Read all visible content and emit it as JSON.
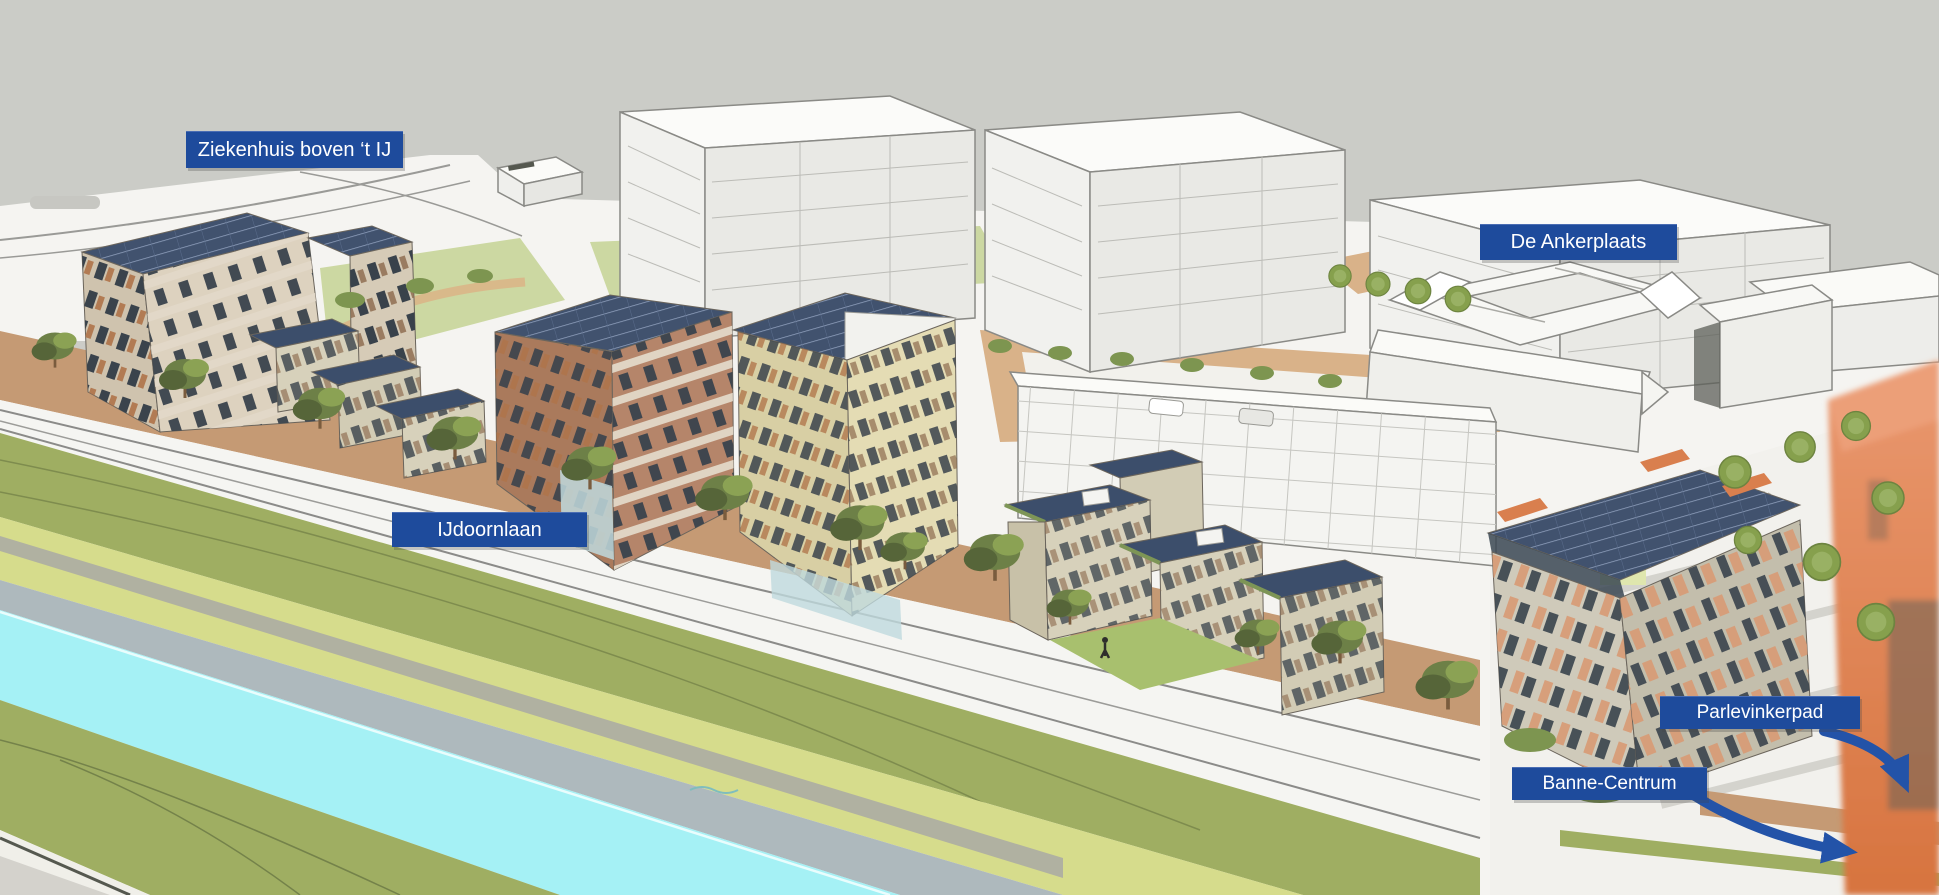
{
  "annotations": {
    "labels": [
      {
        "id": "ziekenhuis",
        "text": "Ziekenhuis boven ‘t IJ"
      },
      {
        "id": "ankerplaats",
        "text": "De Ankerplaats"
      },
      {
        "id": "ijdoornlaan",
        "text": "IJdoornlaan"
      },
      {
        "id": "parlevinkerpad",
        "text": "Parlevinkerpad"
      },
      {
        "id": "banne-centrum",
        "text": "Banne-Centrum"
      }
    ],
    "label_background": "#1e4b9c",
    "label_text_color": "#ffffff",
    "arrows": [
      {
        "from": "Parlevinkerpad",
        "direction": "down-right"
      },
      {
        "from": "Banne-Centrum",
        "direction": "down-right"
      }
    ],
    "arrow_color": "#2353a8"
  },
  "scene_colors": {
    "sky": "#cbccc7",
    "road": "#f5f5f2",
    "sidewalk_brick": "#c59a74",
    "lawn": "#ccd8a2",
    "grass_verge": "#9fae62",
    "path_band": "#d6dc8c",
    "quay": "#aeb9bd",
    "canal_water": "#a5f1f5",
    "ground_corner": "#d4d2cc",
    "white_building": "#f6f6f3",
    "solar_panel": "#41526e",
    "brick_building": "#aa7a5c",
    "beige_building": "#d8cfa4",
    "townhouse": "#d7d1bb",
    "orange_building": "#e08457",
    "tree_green": "#6d8047"
  }
}
